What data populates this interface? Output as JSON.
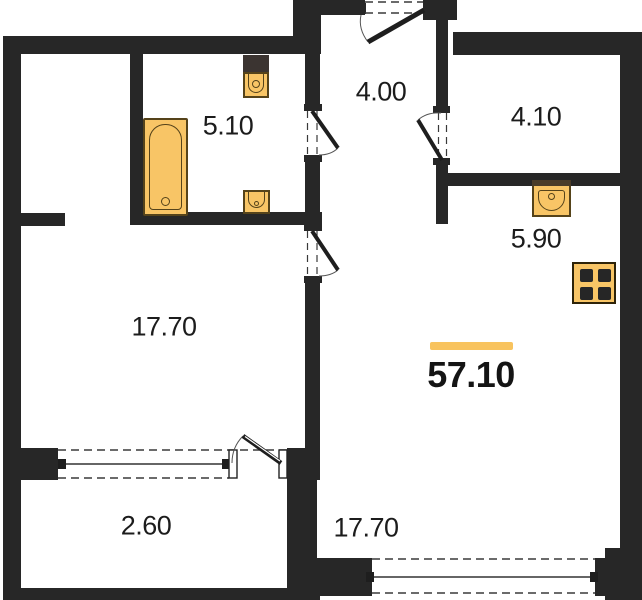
{
  "plan": {
    "title": "apartment-floor-plan",
    "total": {
      "area": "57.10"
    },
    "rooms": {
      "bathroom": {
        "area": "5.10"
      },
      "hallway": {
        "area": "4.00"
      },
      "storage": {
        "area": "4.10"
      },
      "kitchen": {
        "area": "5.90"
      },
      "living_left": {
        "area": "17.70"
      },
      "living_main": {
        "area": "17.70"
      },
      "balcony": {
        "area": "2.60"
      }
    },
    "colors": {
      "wall": "#272727",
      "fixture_fill": "#f8c566",
      "fixture_border": "#55431a",
      "accent_bar": "#f8c35e"
    },
    "fixtures": [
      "bathtub",
      "toilet",
      "bathroom-sink",
      "kitchen-sink",
      "stove"
    ]
  }
}
